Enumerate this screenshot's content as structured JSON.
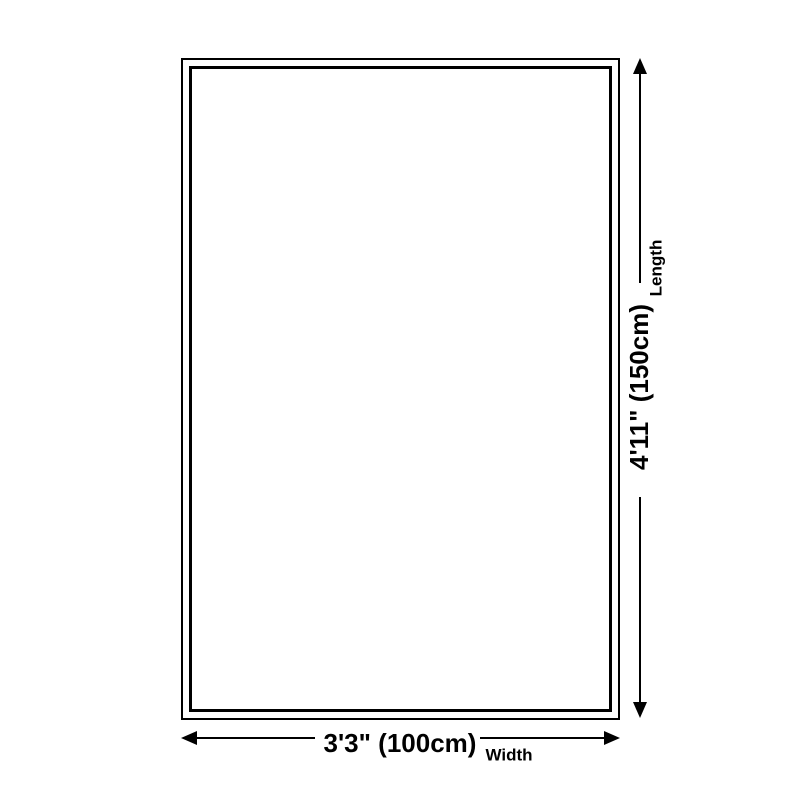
{
  "page": {
    "background_color": "#ffffff",
    "line_color": "#000000"
  },
  "diagram": {
    "type": "product-dimension-diagram",
    "shape": "rectangle-with-double-border",
    "length": {
      "value": "4'11\" (150cm)",
      "label": "Length"
    },
    "width": {
      "value": "3'3\" (100cm)",
      "label": "Width"
    }
  }
}
